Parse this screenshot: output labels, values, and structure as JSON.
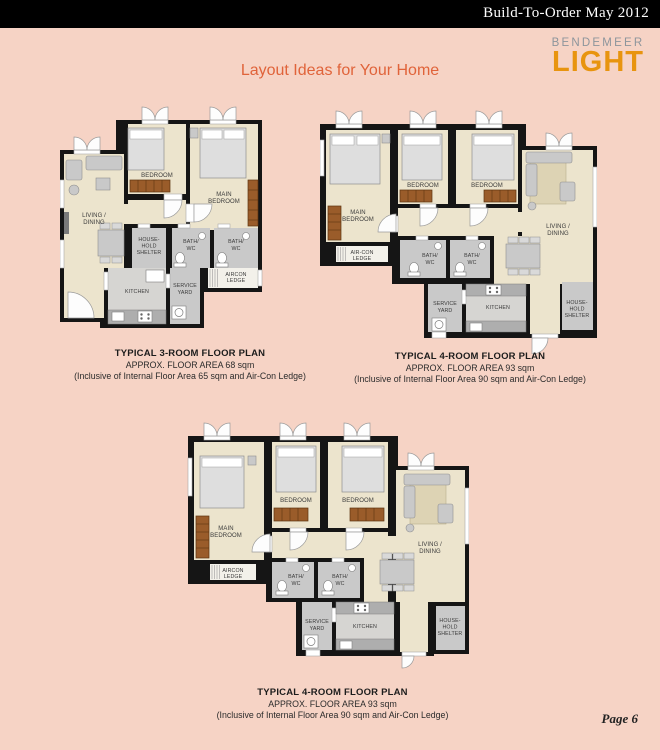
{
  "header": {
    "title": "Build-To-Order May 2012"
  },
  "logo": {
    "name": "BENDEMEER",
    "light": "LIGHT"
  },
  "page_title": "Layout Ideas for Your Home",
  "page_number": "Page 6",
  "colors": {
    "background": "#f6d3c5",
    "header_bg": "#000000",
    "title_orange": "#e0633a",
    "logo_orange": "#e8940f",
    "logo_gray": "#8d959c",
    "floor_cream": "#ece4cd",
    "wet_gray": "#c9c9c9",
    "wardrobe_brown": "#9a5c2a",
    "wall_black": "#151515"
  },
  "plans": [
    {
      "name": "3-room",
      "caption": {
        "title": "TYPICAL 3-ROOM FLOOR PLAN",
        "area": "APPROX. FLOOR AREA 68 sqm",
        "note": "(Inclusive of Internal Floor Area 65 sqm and Air-Con Ledge)"
      },
      "rooms": {
        "living1": "LIVING /",
        "living2": "DINING",
        "bedroom": "BEDROOM",
        "main1": "MAIN",
        "main2": "BEDROOM",
        "shelter1": "HOUSE-",
        "shelter2": "HOLD",
        "shelter3": "SHELTER",
        "bath_a1": "BATH/",
        "bath_a2": "WC",
        "bath_b1": "BATH/",
        "bath_b2": "WC",
        "ledge1": "AIRCON",
        "ledge2": "LEDGE",
        "kitchen": "KITCHEN",
        "service1": "SERVICE",
        "service2": "YARD"
      }
    },
    {
      "name": "4-room-a",
      "caption": {
        "title": "TYPICAL 4-ROOM FLOOR PLAN",
        "area": "APPROX. FLOOR AREA 93 sqm",
        "note": "(Inclusive of Internal Floor Area 90 sqm and Air-Con Ledge)"
      },
      "rooms": {
        "living1": "LIVING /",
        "living2": "DINING",
        "bedroom_a": "BEDROOM",
        "bedroom_b": "BEDROOM",
        "main1": "MAIN",
        "main2": "BEDROOM",
        "shelter1": "HOUSE-",
        "shelter2": "HOLD",
        "shelter3": "SHELTER",
        "bath_a1": "BATH/",
        "bath_a2": "WC",
        "bath_b1": "BATH/",
        "bath_b2": "WC",
        "ledge1": "AIR-CON",
        "ledge2": "LEDGE",
        "kitchen": "KITCHEN",
        "service1": "SERVICE",
        "service2": "YARD"
      }
    },
    {
      "name": "4-room-b",
      "caption": {
        "title": "TYPICAL 4-ROOM FLOOR PLAN",
        "area": "APPROX. FLOOR AREA 93 sqm",
        "note": "(Inclusive of Internal Floor Area 90 sqm and Air-Con Ledge)"
      },
      "rooms": {
        "living1": "LIVING /",
        "living2": "DINING",
        "bedroom_a": "BEDROOM",
        "bedroom_b": "BEDROOM",
        "main1": "MAIN",
        "main2": "BEDROOM",
        "shelter1": "HOUSE-",
        "shelter2": "HOLD",
        "shelter3": "SHELTER",
        "bath_a1": "BATH/",
        "bath_a2": "WC",
        "bath_b1": "BATH/",
        "bath_b2": "WC",
        "ledge1": "AIRCON",
        "ledge2": "LEDGE",
        "kitchen": "KITCHEN",
        "service1": "SERVICE",
        "service2": "YARD"
      }
    }
  ]
}
